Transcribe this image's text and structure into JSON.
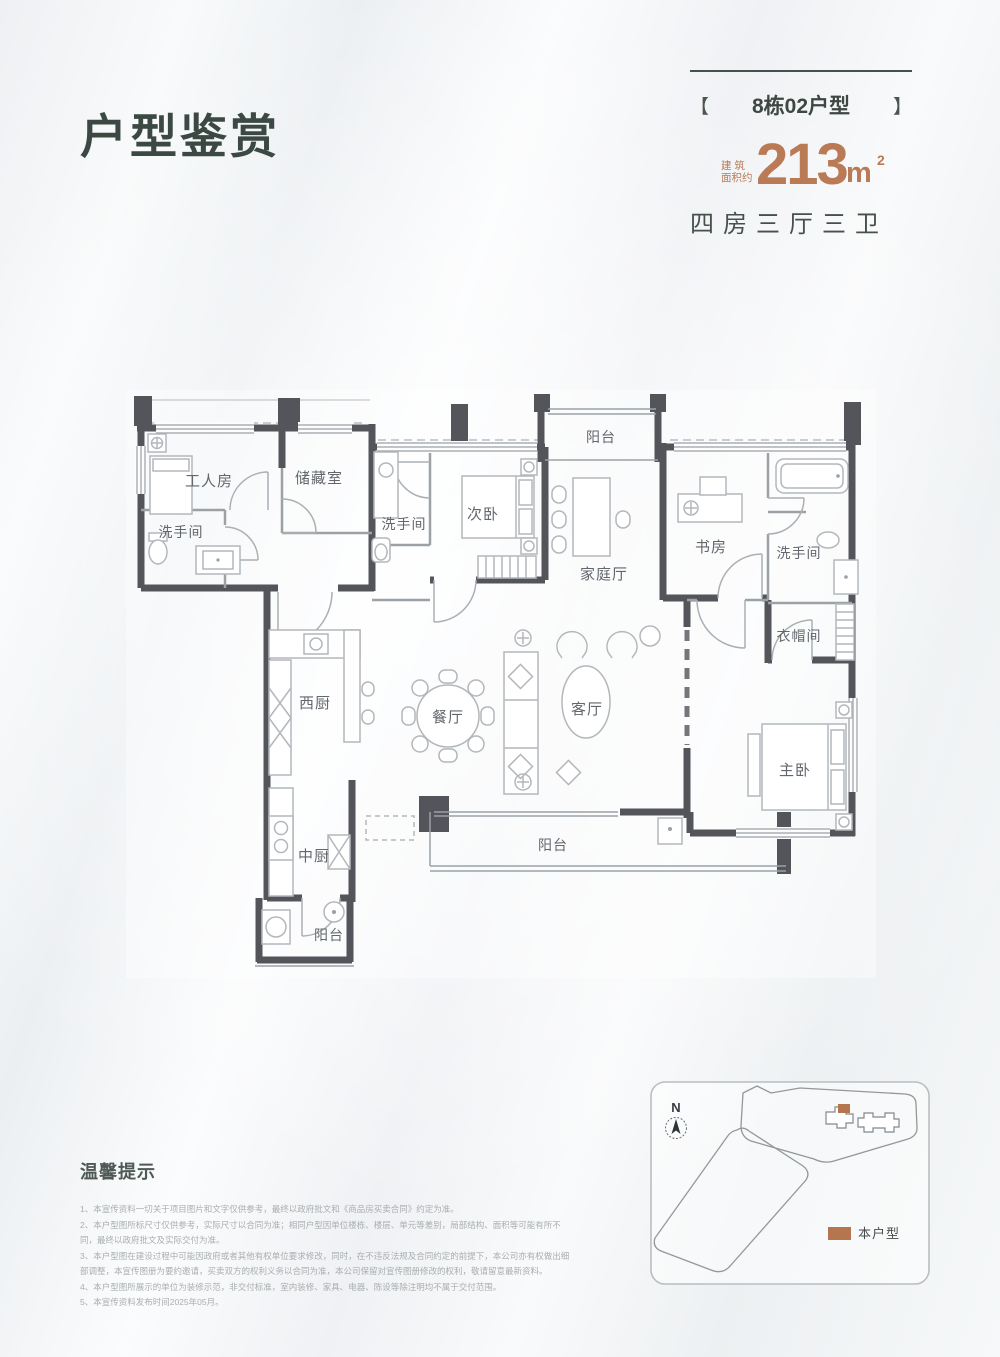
{
  "header": {
    "title": "户型鉴赏",
    "bracket_left": "【",
    "unit_name": "8栋02户型",
    "bracket_right": "】",
    "area_prefix_top": "建 筑",
    "area_prefix_bottom": "面积约",
    "area_value": "213",
    "area_unit": "m",
    "area_sup": "2",
    "layout": "四房三厅三卫"
  },
  "floorplan": {
    "labels": {
      "worker_room": "工人房",
      "storage": "储藏室",
      "bath_left": "洗手间",
      "bath_mid": "洗手间",
      "second_bedroom": "次卧",
      "balcony_top": "阳台",
      "family_hall": "家庭厅",
      "study": "书房",
      "bath_right": "洗手间",
      "cloakroom": "衣帽间",
      "west_kitchen": "西厨",
      "dining": "餐厅",
      "living": "客厅",
      "master_bedroom": "主卧",
      "chinese_kitchen": "中厨",
      "balcony_bottom": "阳台",
      "balcony_kitchen": "阳台"
    }
  },
  "sitemap": {
    "compass": "N",
    "legend": "本户型"
  },
  "tips": {
    "title": "温馨提示",
    "items": [
      "1、本宣传资料一切关于项目图片和文字仅供参考，最终以政府批文和《商品房买卖合同》约定为准。",
      "2、本户型图所标尺寸仅供参考，实际尺寸以合同为准；相同户型因单位楼栋、楼层、单元等差别，局部结构、面积等可能有所不同，最终以政府批文及实际交付为准。",
      "3、本户型图在建设过程中可能因政府或者其他有权单位要求修改，同时，在不违反法规及合同约定的前提下，本公司亦有权做出细部调整，本宣传图册为要约邀请，买卖双方的权利义务以合同为准，本公司保留对宣传图册修改的权利，敬请留意最新资料。",
      "4、本户型图所展示的单位为装修示范，非交付标准，室内装修、家具、电器、陈设等除注明均不属于交付范围。",
      "5、本宣传资料发布时间2025年05月。"
    ]
  },
  "colors": {
    "accent": "#b97a55",
    "title": "#3c4842",
    "wall": "#53555a",
    "legend_swatch": "#b5764f"
  }
}
